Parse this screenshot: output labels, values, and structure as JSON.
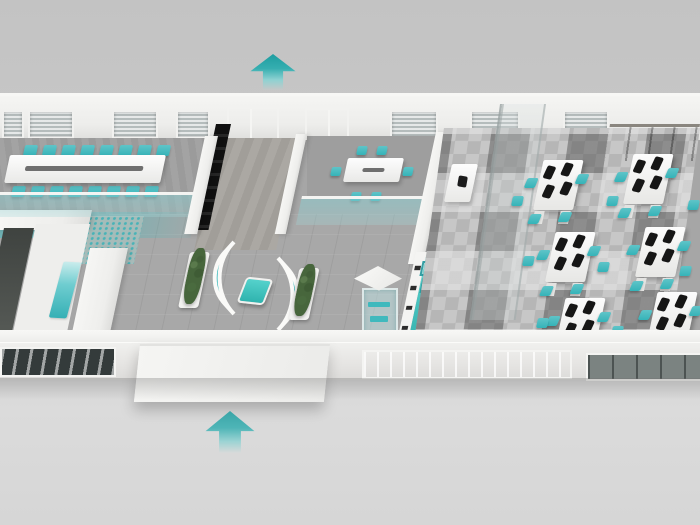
{
  "scene": {
    "kind": "isometric-3d-office-floorplan-render",
    "width": 700,
    "height": 525
  },
  "palette": {
    "background_gray": "#c9c9c9",
    "wall_white": "#f2f2f0",
    "floor_gray": "#a6a6a6",
    "carpet_dark_tile": "#5f5f5f",
    "carpet_light_tile": "#c7c7c7",
    "accent_teal": "#35b3b8",
    "accent_teal_bright": "#4fd6cf",
    "glass_teal": "#9ed2d4",
    "monitor_black": "#161616",
    "cabinet_dark": "#55514c",
    "plant_green": "#47663c",
    "arrow_teal": "#1e9da0"
  },
  "arrows": [
    {
      "id": "top",
      "direction": "up"
    },
    {
      "id": "bottom",
      "direction": "up"
    }
  ],
  "back_wall": {
    "windows": [
      {
        "x": 2,
        "w": 18
      },
      {
        "x": 28,
        "w": 42
      },
      {
        "x": 112,
        "w": 42
      },
      {
        "x": 176,
        "w": 30
      },
      {
        "x": 390,
        "w": 44
      },
      {
        "x": 470,
        "w": 46
      },
      {
        "x": 563,
        "w": 42
      }
    ]
  },
  "conference_room": {
    "long_table": 1,
    "chair_rows": {
      "top": {
        "y": 145,
        "x0": 24,
        "dx": 19,
        "n": 8
      },
      "bottom": {
        "y": 186,
        "x0": 12,
        "dx": 19,
        "n": 8
      }
    }
  },
  "meeting_room": {
    "table": 1,
    "chairs": [
      {
        "x": 357,
        "y": 146
      },
      {
        "x": 377,
        "y": 146
      },
      {
        "x": 351,
        "y": 192
      },
      {
        "x": 371,
        "y": 192
      },
      {
        "x": 331,
        "y": 167
      },
      {
        "x": 403,
        "y": 167
      }
    ]
  },
  "lobby": {
    "curved_benches": 2,
    "planters": 2,
    "coffee_table": 1,
    "display_case": 1
  },
  "reception": {
    "stools": {
      "x": 421,
      "y0": 261,
      "dy": 17,
      "n": 4
    }
  },
  "open_office": {
    "desk_clusters": [
      {
        "x": 540,
        "y": 158
      },
      {
        "x": 630,
        "y": 152
      },
      {
        "x": 552,
        "y": 230
      },
      {
        "x": 642,
        "y": 225
      },
      {
        "x": 562,
        "y": 296
      },
      {
        "x": 654,
        "y": 290
      }
    ],
    "monitors_per_desk": 4,
    "chairs_per_desk": 4,
    "loose_chairs": [
      {
        "x": 512,
        "y": 196
      },
      {
        "x": 523,
        "y": 256
      },
      {
        "x": 598,
        "y": 262
      },
      {
        "x": 607,
        "y": 196
      },
      {
        "x": 688,
        "y": 200
      },
      {
        "x": 680,
        "y": 266
      },
      {
        "x": 612,
        "y": 326
      },
      {
        "x": 537,
        "y": 318
      }
    ]
  }
}
